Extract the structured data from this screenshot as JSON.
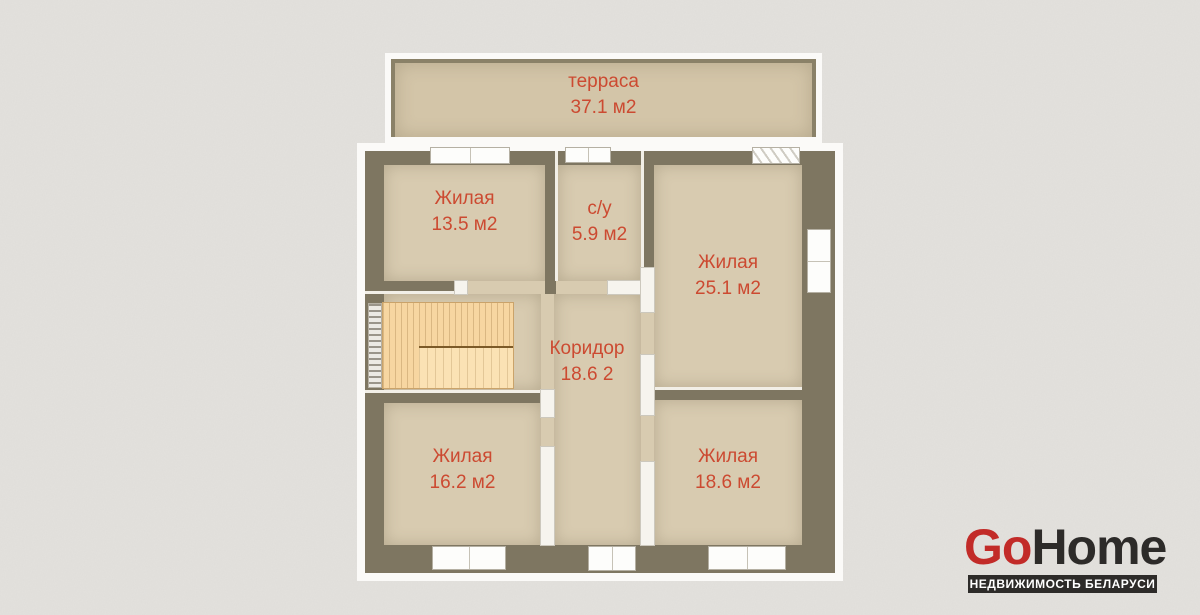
{
  "palette": {
    "background": "#e3e1dd",
    "wall": "#7e7661",
    "floor": "#d8cbb0",
    "terrace_floor": "#d3c5a8",
    "label_red": "#cc4a31",
    "stairs": "#f7d6a1",
    "logo_red": "#c22b28",
    "logo_dark": "#2d2b29"
  },
  "rooms": {
    "terrace": {
      "label": "терраса",
      "area": "37.1 м2"
    },
    "living_top_left": {
      "label": "Жилая",
      "area": "13.5 м2"
    },
    "bathroom": {
      "label": "с/у",
      "area": "5.9 м2"
    },
    "living_top_right": {
      "label": "Жилая",
      "area": "25.1 м2"
    },
    "corridor": {
      "label": "Коридор",
      "area": "18.6 2"
    },
    "living_bottom_left": {
      "label": "Жилая",
      "area": "16.2 м2"
    },
    "living_bottom_right": {
      "label": "Жилая",
      "area": "18.6 м2"
    }
  },
  "logo": {
    "go": "Go",
    "home": "Home",
    "tagline": "НЕДВИЖИМОСТЬ БЕЛАРУСИ"
  }
}
